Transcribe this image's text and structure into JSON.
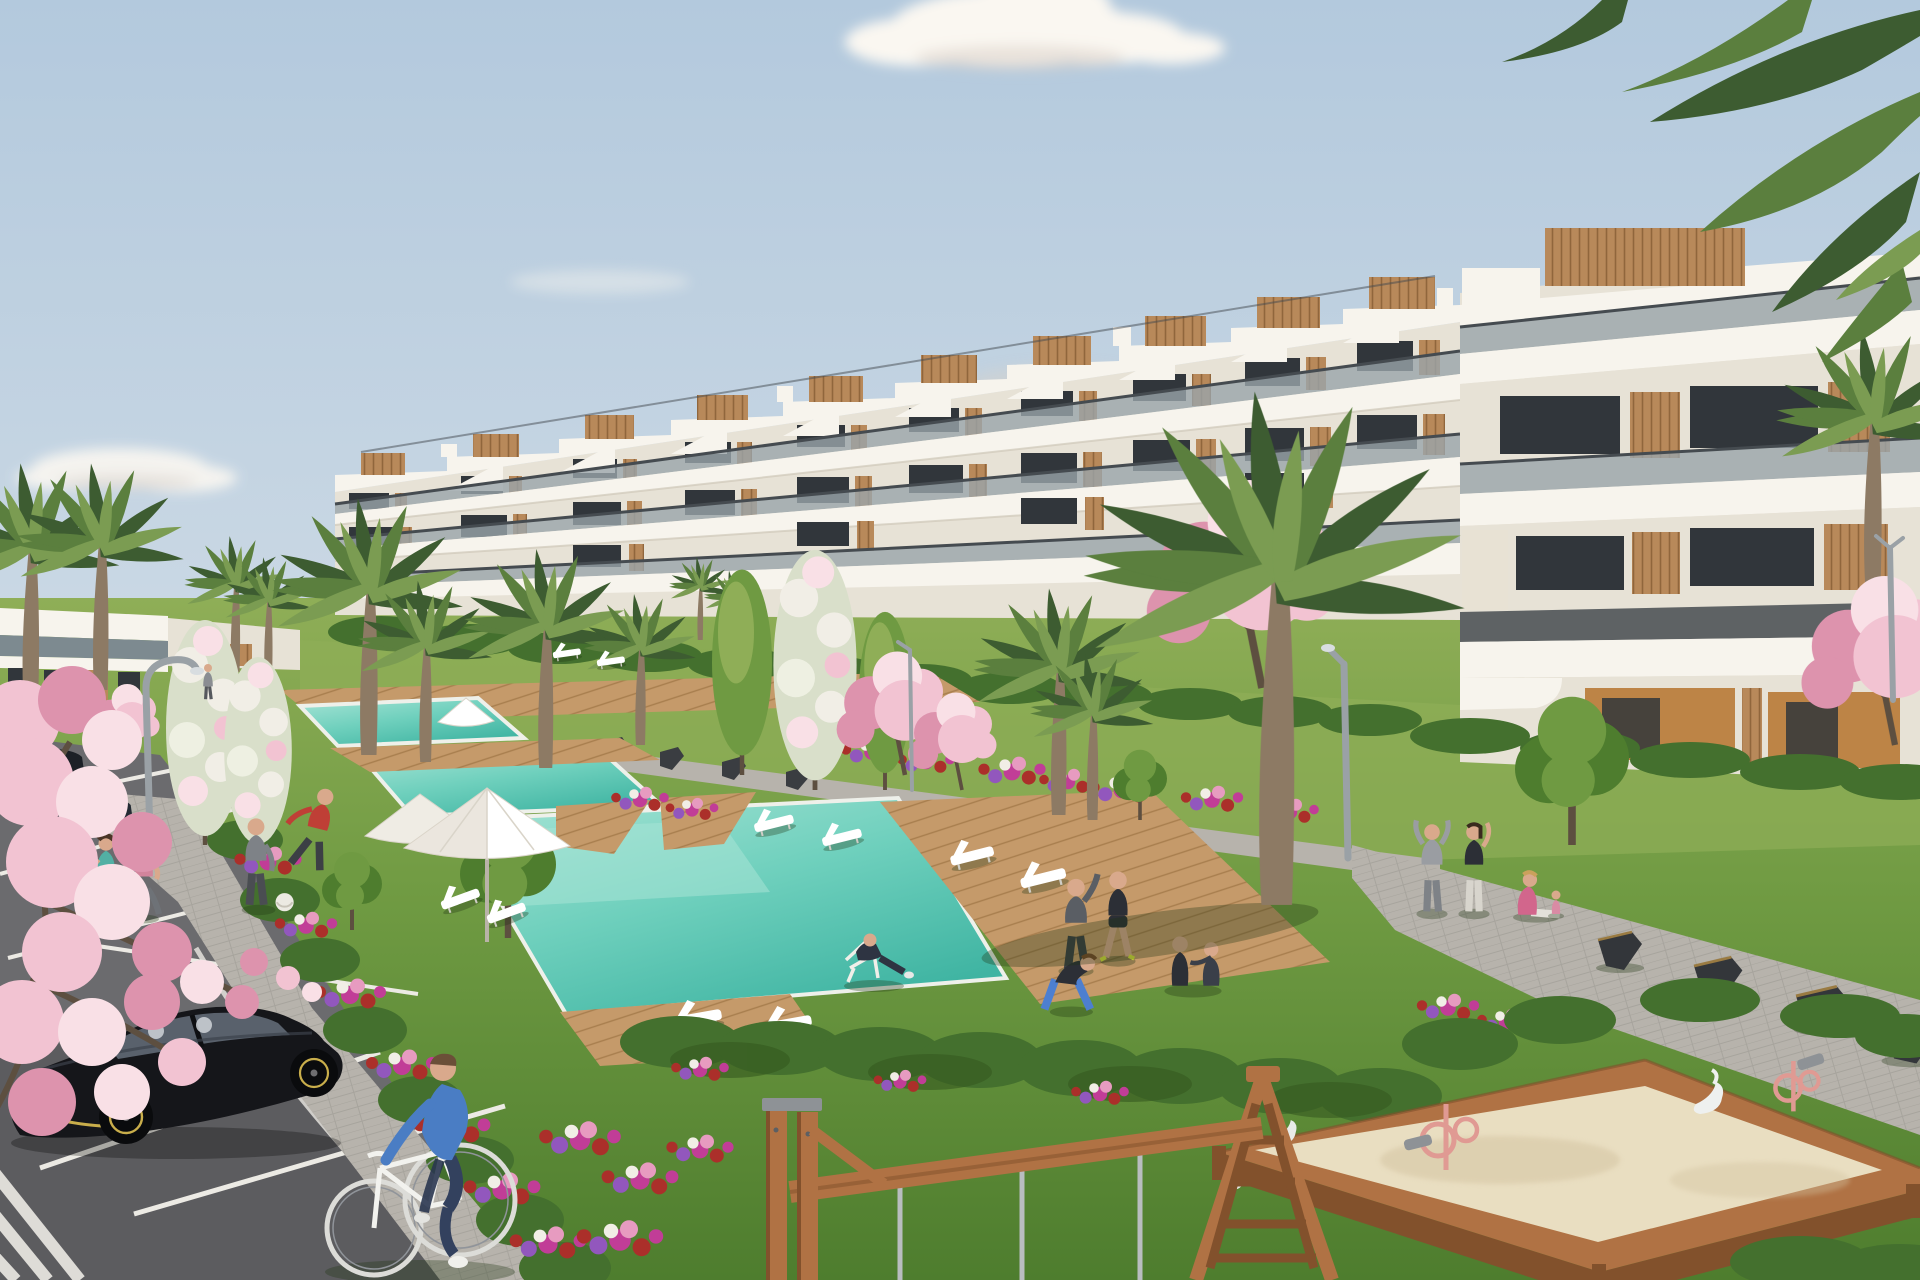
{
  "scene": {
    "type": "architectural-render",
    "description": "Sunny 3D visualization of a modern white terraced apartment complex with communal gardens, stepped swimming pools, wooden sun decks, palm trees, pink blossom trees, a parking lot with cars, a cyclist, joggers, people exercising on lawns, and a children's playground with a sandbox and wooden swing frame.",
    "objects": [
      "sky",
      "clouds",
      "terraced-white-apartment-building",
      "rooftop-wood-cladding",
      "glass-balconies",
      "distant-white-building",
      "palm-trees",
      "pink-blossom-trees",
      "white-flowering-trees",
      "lap-pools",
      "main-swimming-pool",
      "wooden-pool-deck",
      "white-sun-loungers",
      "white-parasols",
      "curved-street-lamps",
      "flower-beds",
      "hedges",
      "lawns",
      "paved-walkways",
      "dark-angular-benches",
      "parking-lot",
      "white-parking-lines",
      "black-hatchback-car",
      "dark-sedans",
      "cyclist-on-white-bicycle",
      "joggers",
      "man-with-football",
      "people-stretching",
      "yoga-group",
      "man-on-deck-chair",
      "children-sandbox",
      "pink-sand-toys",
      "white-swan-springers",
      "wooden-swing-frame",
      "wooden-ladder-frame"
    ],
    "people_count": 16,
    "car_count": 3,
    "pool_count": 3
  },
  "palette": {
    "sky-top": "#b3c9dd",
    "sky-mid": "#cddae5",
    "horizon": "#e9e6da",
    "cloud": "#faf7f1",
    "cloud-shadow": "#d9d0c8",
    "facade-white": "#f7f4ed",
    "facade-shade": "#e7e2d6",
    "facade-dark": "#cfc8b9",
    "wood": "#b8895a",
    "wood-dark": "#90663c",
    "wood-light": "#cfa876",
    "glass": "#31363b",
    "glass-light": "#7d8a90",
    "rail": "#454b50",
    "rail-light": "#9aa5aa",
    "ochre": "#bd8446",
    "grass-light": "#8fae57",
    "grass-mid": "#6f9a42",
    "grass-dark": "#4e7d2e",
    "grass-deep": "#3f6b26",
    "hedge": "#44702e",
    "hedge-dark": "#35591f",
    "flower-magenta": "#c13d97",
    "flower-red": "#ab2f2a",
    "flower-purple": "#9257bd",
    "flower-pink": "#e79bc0",
    "flower-white": "#f1eee6",
    "pool-light": "#a8e4d6",
    "pool-mid": "#6fd0bd",
    "pool-deep": "#3fb4a2",
    "pool-edge": "#eef0ea",
    "deck": "#c59a6a",
    "deck-dark": "#a87e4e",
    "path": "#b7b3ac",
    "path-dark": "#9d9992",
    "asphalt": "#6b6b6e",
    "asphalt-dark": "#515154",
    "line-white": "#eceae4",
    "blossom": "#f2c3d2",
    "blossom-deep": "#dd93ad",
    "blossom-light": "#f9e0e6",
    "palm-dark": "#3d5c31",
    "palm-mid": "#5b7f3e",
    "palm-light": "#7b9c52",
    "trunk": "#8d7a64",
    "trunk-dark": "#5d4f40",
    "sand": "#e9dec1",
    "sand-shadow": "#d3c3a0",
    "play-wood": "#b07244",
    "play-wood-dark": "#82512c",
    "metal": "#b9bdc0",
    "lamp": "#9aa1a6",
    "white": "#ffffff",
    "car-black": "#15161a",
    "car-glass": "#59616c",
    "car-shine": "#3c424c",
    "gold": "#c9ae4b",
    "denim": "#33415e",
    "sweater": "#4a7dc4",
    "skin": "#d9a98c",
    "teal": "#52b0a4",
    "pink-top": "#d2849c",
    "red-shirt": "#bf3f36",
    "dark-outfit": "#2c2f36",
    "grey-outfit": "#7e8287"
  }
}
